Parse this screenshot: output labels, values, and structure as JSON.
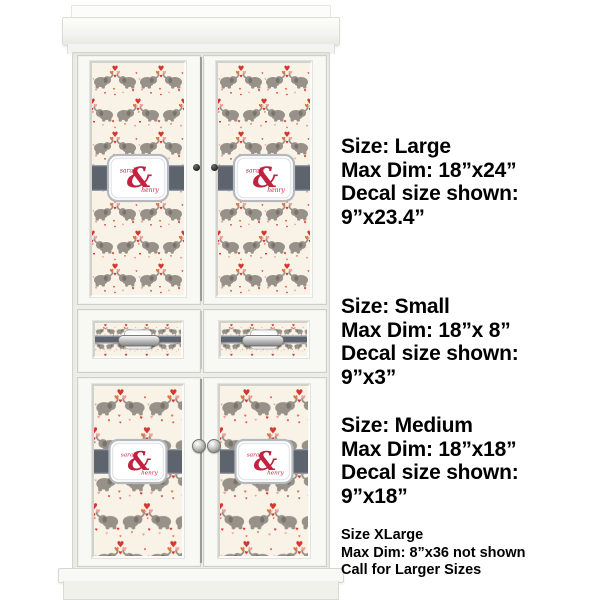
{
  "decal": {
    "name_top": "sarah",
    "name_bottom": "henry",
    "ampersand": "&",
    "colors": {
      "background": "#f8f3e6",
      "elephant": "#97918a",
      "elephant_dark": "#7a746b",
      "heart_red": "#d23830",
      "heart_orange": "#e1753e",
      "heart_pink": "#ef9f9a",
      "band": "#5d646e",
      "band_edge": "#959ca5",
      "label_border": "#b4b9bf",
      "script": "#c12240"
    }
  },
  "size_blocks": [
    {
      "size_label": "Size: Large",
      "max_dim": "Max Dim: 18”x24”",
      "shown_label": "Decal size shown:",
      "shown_value": "9”x23.4”"
    },
    {
      "size_label": "Size: Small",
      "max_dim": "Max Dim: 18”x 8”",
      "shown_label": "Decal size shown:",
      "shown_value": "9”x3”"
    },
    {
      "size_label": "Size: Medium",
      "max_dim": "Max Dim: 18”x18”",
      "shown_label": "Decal size shown:",
      "shown_value": "9”x18”"
    }
  ],
  "xlarge_note": {
    "line1": "Size XLarge",
    "line2": "Max Dim: 8”x36 not shown",
    "line3": "Call for Larger Sizes"
  }
}
